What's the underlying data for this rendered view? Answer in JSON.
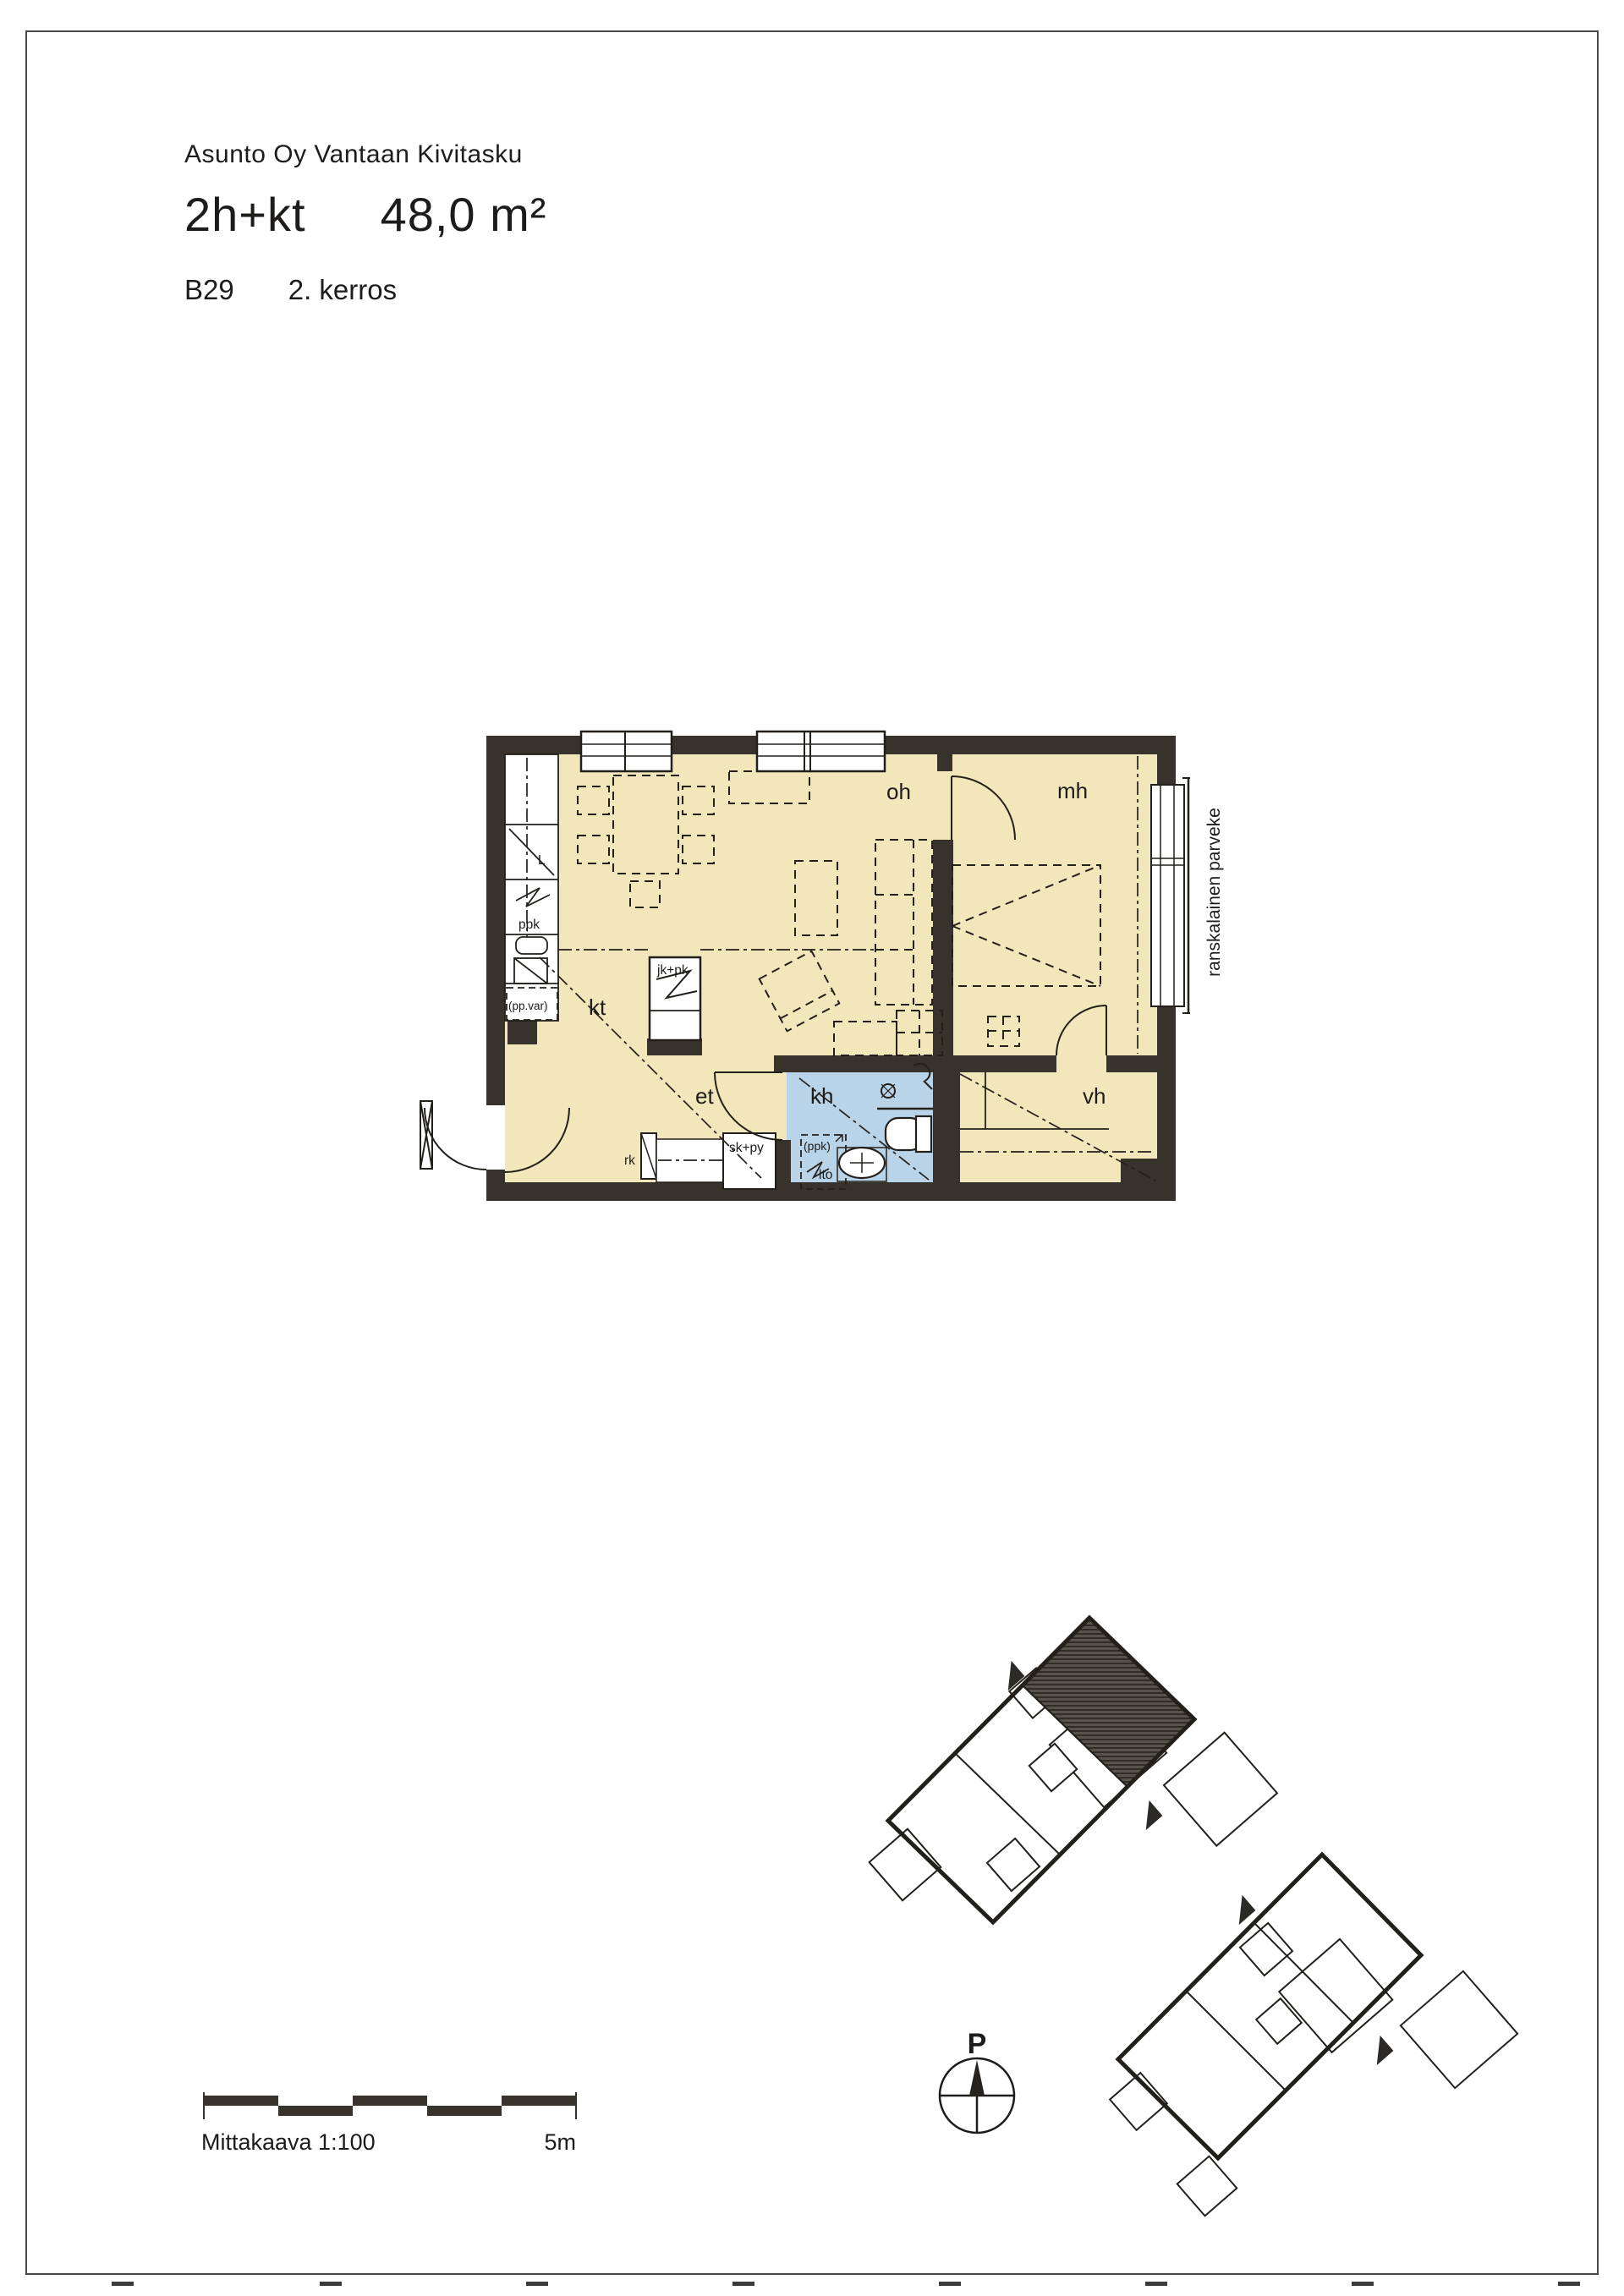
{
  "document": {
    "housing_company": "Asunto Oy Vantaan Kivitasku",
    "apartment_type": "2h+kt",
    "apartment_area": "48,0 m²",
    "apartment_number": "B29",
    "floor": "2. kerros"
  },
  "floor_plan": {
    "rooms": [
      {
        "abbr": "oh"
      },
      {
        "abbr": "mh"
      },
      {
        "abbr": "kt"
      },
      {
        "abbr": "et"
      },
      {
        "abbr": "kh"
      },
      {
        "abbr": "vh"
      }
    ],
    "balcony_label": "ranskalainen parveke",
    "fixture_labels": [
      {
        "id": "stove",
        "text": "L"
      },
      {
        "id": "ppk",
        "text": "ppk"
      },
      {
        "id": "pp-var",
        "text": "(pp.var)"
      },
      {
        "id": "jk-pk",
        "text": "jk+pk"
      },
      {
        "id": "rk",
        "text": "rk"
      },
      {
        "id": "sk-py",
        "text": "sk+py"
      },
      {
        "id": "ppk-paren",
        "text": "(ppk)"
      },
      {
        "id": "lto",
        "text": "lto"
      }
    ],
    "colors": {
      "floor": "#f2e6bb",
      "wet_room": "#b9d4e9",
      "wall": "#37322b"
    }
  },
  "footer": {
    "scale_label": "Mittakaava 1:100",
    "scale_end_label": "5m",
    "compass_label": "P"
  }
}
